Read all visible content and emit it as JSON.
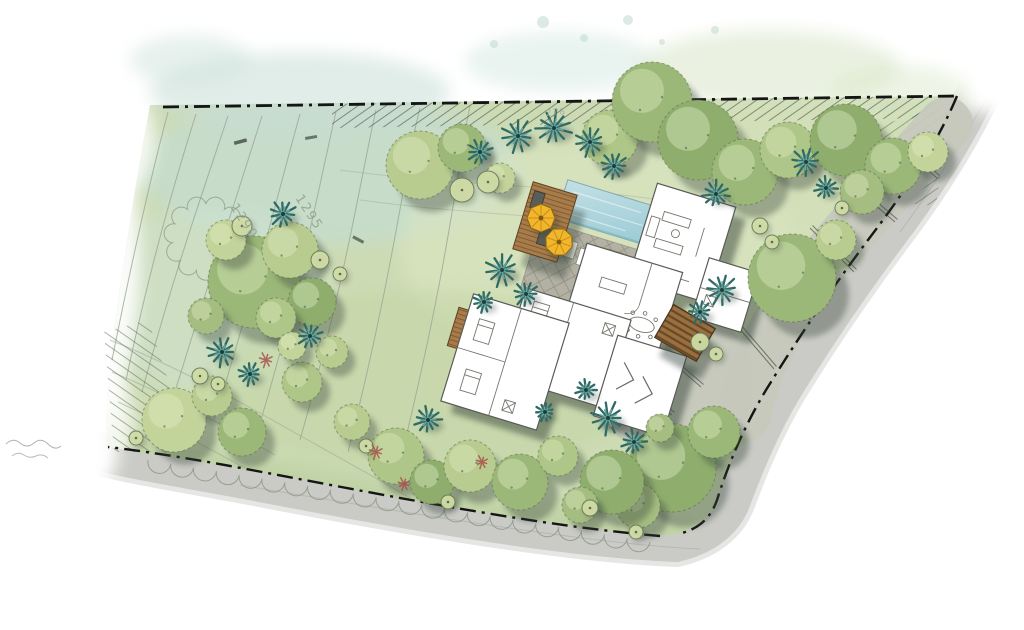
{
  "plan": {
    "contour_labels": [
      {
        "id": "contour-1290",
        "text": "1290"
      },
      {
        "id": "contour-1295",
        "text": "1295"
      },
      {
        "id": "boundary-276",
        "text": "276"
      }
    ],
    "palette": {
      "grass_base": "#ccdbb4",
      "grass_light": "#dce7c2",
      "grass_olive": "#b7cd9c",
      "wash_teal": "#c5ddd4",
      "canopy_tones": [
        "#c3d49b",
        "#aec687",
        "#9cb878",
        "#8fae6e",
        "#b8cc90",
        "#a5bd80"
      ],
      "canopy_outline": "#5c6a4d",
      "canopy_highlight": "#e6eec9",
      "palm_dark": "#2f6b66",
      "palm_light": "#6aa49c",
      "palm_center": "#1f3d39",
      "shrub_fill": "#cfdca6",
      "shrub_line": "#6d7c5a",
      "accent_red": "#a8524a",
      "pool_water": "#b5d8df",
      "pool_deep": "#9ccbd6",
      "deck_wood": "#a87c4a",
      "deck_plank_line": "#6e4c28",
      "umbrella_yellow": "#f1b62c",
      "stone_patio": "#b2afa2",
      "patio_line": "#7d7a6e",
      "road_gray": "#c8c9c4",
      "driveway_gray": "#c6c8bd",
      "house_fill": "#ffffff",
      "house_line": "#5a5a56",
      "shadow_dark": "#39443a",
      "boundary_black": "#151515",
      "contour_line": "#9aa594",
      "scallop_line": "#8a9383"
    },
    "vegetation": {
      "canopies": [
        [
          420,
          165,
          34,
          4
        ],
        [
          462,
          148,
          24,
          2
        ],
        [
          500,
          178,
          15,
          0
        ],
        [
          610,
          138,
          28,
          1
        ],
        [
          652,
          102,
          40,
          2
        ],
        [
          698,
          140,
          40,
          3
        ],
        [
          745,
          172,
          33,
          2
        ],
        [
          788,
          150,
          28,
          1
        ],
        [
          846,
          140,
          36,
          3
        ],
        [
          893,
          166,
          28,
          2
        ],
        [
          928,
          152,
          20,
          0
        ],
        [
          862,
          192,
          22,
          5
        ],
        [
          792,
          278,
          44,
          2
        ],
        [
          836,
          240,
          20,
          4
        ],
        [
          672,
          468,
          44,
          3
        ],
        [
          714,
          432,
          26,
          2
        ],
        [
          638,
          506,
          22,
          5
        ],
        [
          254,
          282,
          46,
          2
        ],
        [
          290,
          250,
          28,
          4
        ],
        [
          226,
          240,
          20,
          0
        ],
        [
          312,
          302,
          24,
          3
        ],
        [
          206,
          316,
          18,
          5
        ],
        [
          276,
          318,
          20,
          1
        ],
        [
          174,
          420,
          32,
          0
        ],
        [
          212,
          396,
          20,
          4
        ],
        [
          242,
          432,
          24,
          2
        ],
        [
          302,
          382,
          20,
          1
        ],
        [
          332,
          352,
          16,
          4
        ],
        [
          292,
          346,
          14,
          0
        ],
        [
          352,
          422,
          18,
          4
        ],
        [
          396,
          456,
          28,
          1
        ],
        [
          432,
          482,
          22,
          3
        ],
        [
          470,
          466,
          26,
          4
        ],
        [
          520,
          482,
          28,
          2
        ],
        [
          558,
          456,
          20,
          1
        ],
        [
          612,
          482,
          32,
          3
        ],
        [
          580,
          505,
          18,
          5
        ],
        [
          660,
          428,
          14,
          5
        ]
      ],
      "palms": [
        [
          480,
          152,
          12
        ],
        [
          518,
          136,
          16
        ],
        [
          554,
          128,
          17
        ],
        [
          590,
          142,
          14
        ],
        [
          614,
          166,
          13
        ],
        [
          806,
          162,
          14
        ],
        [
          826,
          188,
          11
        ],
        [
          716,
          194,
          13
        ],
        [
          722,
          290,
          15
        ],
        [
          700,
          312,
          11
        ],
        [
          502,
          270,
          16
        ],
        [
          526,
          294,
          12
        ],
        [
          484,
          302,
          10
        ],
        [
          283,
          214,
          13
        ],
        [
          222,
          352,
          14
        ],
        [
          250,
          374,
          11
        ],
        [
          310,
          336,
          12
        ],
        [
          428,
          420,
          13
        ],
        [
          608,
          418,
          16
        ],
        [
          634,
          442,
          12
        ],
        [
          586,
          390,
          10
        ],
        [
          545,
          412,
          9
        ]
      ],
      "shrubs": [
        [
          462,
          190,
          12
        ],
        [
          488,
          182,
          11
        ],
        [
          242,
          226,
          10
        ],
        [
          320,
          260,
          9
        ],
        [
          340,
          274,
          7
        ],
        [
          200,
          376,
          8
        ],
        [
          218,
          384,
          7
        ],
        [
          760,
          226,
          8
        ],
        [
          772,
          242,
          7
        ],
        [
          700,
          342,
          9
        ],
        [
          716,
          354,
          7
        ],
        [
          366,
          446,
          7
        ],
        [
          448,
          502,
          7
        ],
        [
          590,
          508,
          8
        ],
        [
          636,
          532,
          7
        ],
        [
          136,
          438,
          7
        ],
        [
          842,
          208,
          7
        ]
      ],
      "accents": [
        [
          266,
          360,
          8
        ],
        [
          376,
          452,
          8
        ],
        [
          404,
          484,
          7
        ],
        [
          482,
          462,
          7
        ]
      ]
    }
  }
}
